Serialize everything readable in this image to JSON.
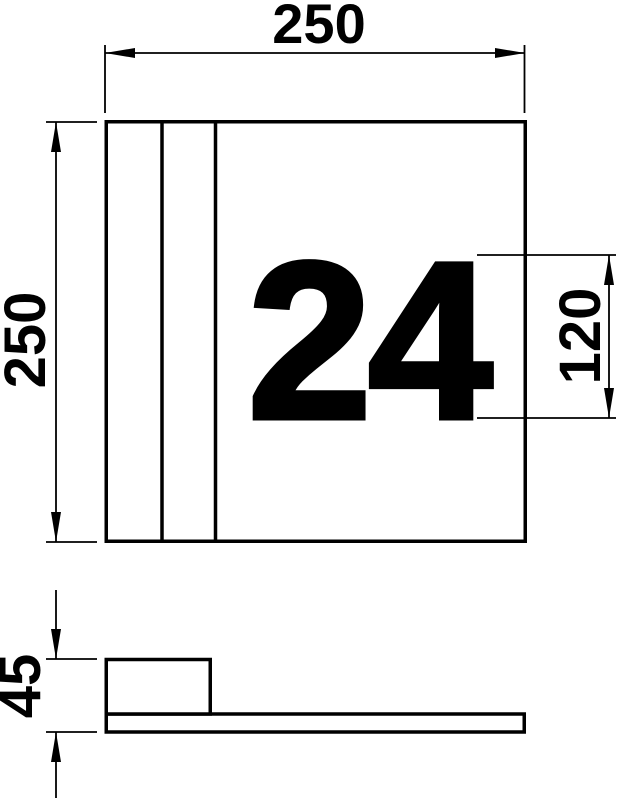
{
  "drawing": {
    "house_number": "24",
    "dimensions": {
      "width": {
        "label": "250"
      },
      "height": {
        "label": "250"
      },
      "digit_height": {
        "label": "120"
      },
      "depth": {
        "label": "45"
      }
    },
    "colors": {
      "line": "#000000",
      "background": "#ffffff"
    }
  }
}
